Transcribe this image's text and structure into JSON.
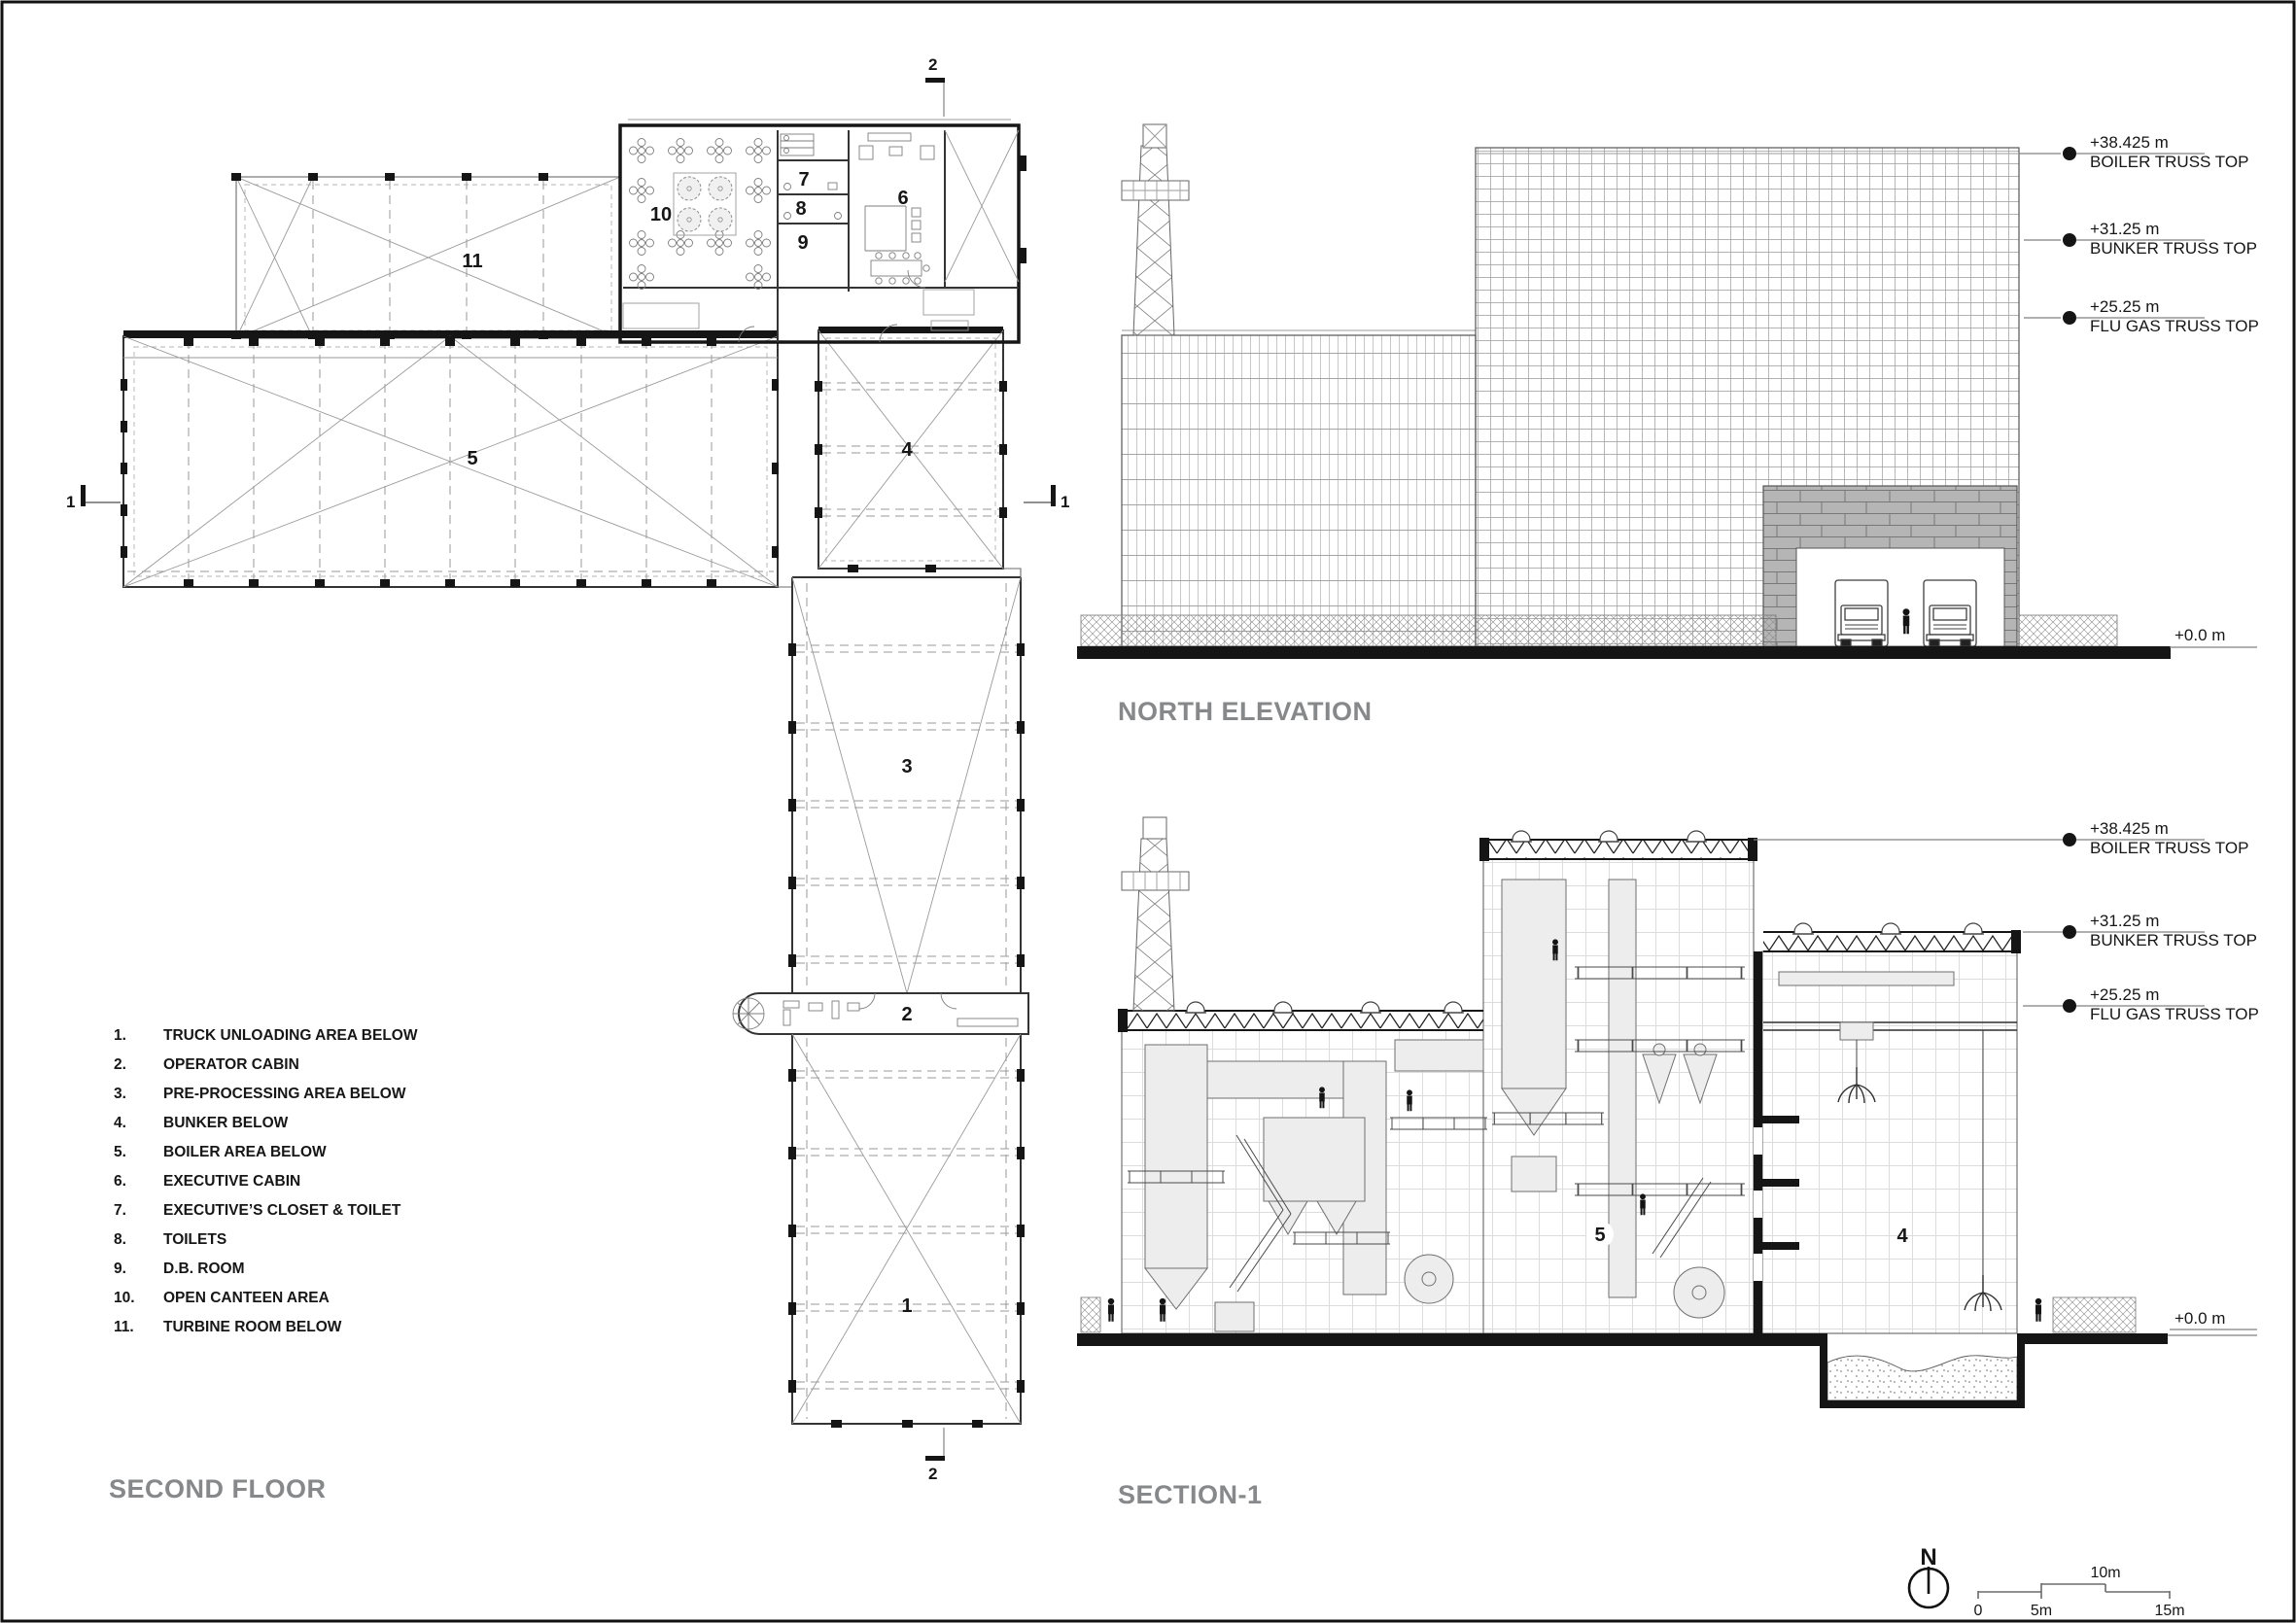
{
  "colors": {
    "accent_red": "#ed1c24",
    "title_gray": "#87888a"
  },
  "titles": {
    "plan": "SECOND FLOOR",
    "elevation": "NORTH ELEVATION",
    "section": "SECTION-1"
  },
  "legend": {
    "items": [
      {
        "num": "1.",
        "label": "TRUCK UNLOADING AREA BELOW"
      },
      {
        "num": "2.",
        "label": "OPERATOR CABIN"
      },
      {
        "num": "3.",
        "label": "PRE-PROCESSING AREA BELOW"
      },
      {
        "num": "4.",
        "label": "BUNKER BELOW"
      },
      {
        "num": "5.",
        "label": "BOILER AREA BELOW"
      },
      {
        "num": "6.",
        "label": "EXECUTIVE CABIN"
      },
      {
        "num": "7.",
        "label": "EXECUTIVE’S CLOSET & TOILET"
      },
      {
        "num": "8.",
        "label": "TOILETS"
      },
      {
        "num": "9.",
        "label": "D.B. ROOM"
      },
      {
        "num": "10.",
        "label": "OPEN CANTEEN AREA"
      },
      {
        "num": "11.",
        "label": "TURBINE ROOM BELOW"
      }
    ]
  },
  "areas": {
    "n1": "1",
    "n2": "2",
    "n3": "3",
    "n4": "4",
    "n5": "5",
    "n6": "6",
    "n7": "7",
    "n8": "8",
    "n9": "9",
    "n10": "10",
    "n11": "11"
  },
  "levels": [
    {
      "value": "+38.425 m",
      "name": "BOILER TRUSS TOP"
    },
    {
      "value": "+31.25 m",
      "name": "BUNKER TRUSS TOP"
    },
    {
      "value": "+25.25 m",
      "name": "FLU GAS TRUSS TOP"
    }
  ],
  "ground_level": "+0.0 m",
  "section_markers": {
    "one": "1",
    "two": "2"
  },
  "compass": {
    "north": "N"
  },
  "scale_bar": {
    "t0": "0",
    "t5": "5m",
    "t10": "10m",
    "t15": "15m"
  }
}
